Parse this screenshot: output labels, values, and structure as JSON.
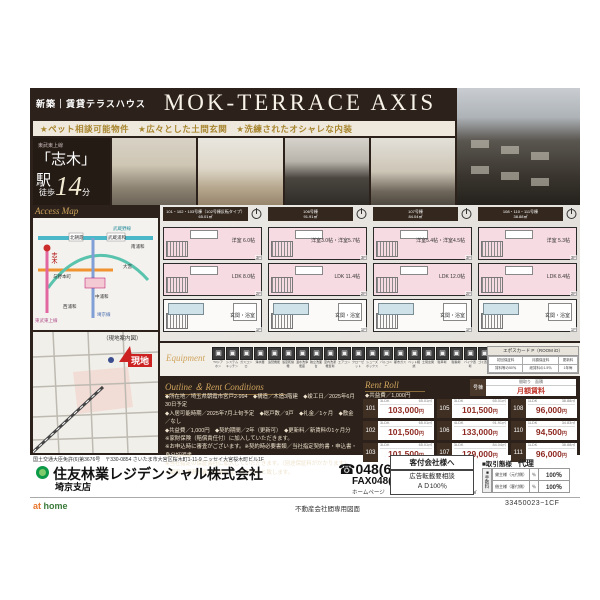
{
  "header": {
    "badge": "新築｜賃貸テラスハウス",
    "title": "MOK-TERRACE AXIS",
    "tagline": "★ペット相談可能物件　★広々とした土間玄関　★洗練されたオシャレな内装"
  },
  "station": {
    "line": "東武東上線",
    "name": "「志木」駅",
    "walk_pre": "徒歩",
    "walk_num": "14",
    "walk_post": "分"
  },
  "access_map": {
    "label": "Access Map",
    "stations": [
      "志木",
      "北朝霞",
      "武蔵浦和",
      "南浦和",
      "大宮",
      "与野本町",
      "中浦和",
      "西浦和"
    ],
    "lines": [
      "武蔵野線",
      "埼京線",
      "東武東上線"
    ],
    "site_caption": "（現地案内図）",
    "site_label": "現地"
  },
  "plans": [
    {
      "title": "101・102・103号棟（102号棟反転タイプ）",
      "area": "65.01㎡",
      "floors": [
        {
          "tag": "3F",
          "label": "洋室 6.0帖"
        },
        {
          "tag": "2F",
          "label": "LDK 8.0帖"
        },
        {
          "tag": "1F",
          "label": "玄関・浴室"
        }
      ]
    },
    {
      "title": "106号棟",
      "area": "91.91㎡",
      "floors": [
        {
          "tag": "3F",
          "label": "洋室3.0帖・洋室5.7帖"
        },
        {
          "tag": "2F",
          "label": "LDK 11.4帖"
        },
        {
          "tag": "1F",
          "label": "玄関・浴室"
        }
      ]
    },
    {
      "title": "107号棟",
      "area": "84.04㎡",
      "floors": [
        {
          "tag": "3F",
          "label": "洋室5.4帖・洋室4.5帖"
        },
        {
          "tag": "2F",
          "label": "LDK 12.0帖"
        },
        {
          "tag": "1F",
          "label": "玄関・浴室"
        }
      ]
    },
    {
      "title": "108・110・111号棟",
      "area": "38.88㎡",
      "floors": [
        {
          "tag": "3F",
          "label": "洋室 5.3帖"
        },
        {
          "tag": "2F",
          "label": "LDK 8.4帖"
        },
        {
          "tag": "1F",
          "label": "玄関・浴室"
        }
      ]
    }
  ],
  "equipment": {
    "label": "Equipment",
    "items": [
      "TVドアホン",
      "システムキッチン",
      "ガスコンロ",
      "浄水器",
      "追焚機能",
      "浴室乾燥機",
      "温水洗浄便座",
      "独立洗面台",
      "室内洗濯機置場",
      "エアコン",
      "クローゼット",
      "シューズボックス",
      "バルコニー",
      "都市ガス",
      "ペット相談",
      "土間玄関",
      "駐車場",
      "駐輪場",
      "バイク置場",
      "ゴミ置場"
    ],
    "card": {
      "title": "エポスカード P（ROOM iD）",
      "headers": [
        "初回保証料",
        "月額保証料",
        "更新料"
      ],
      "values": [
        "賃料等の50％",
        "総賃料の1.5％",
        "1年毎"
      ]
    }
  },
  "outline": {
    "title": "Outline ＆ Rent Conditions",
    "lines": [
      "◆所在地／埼玉県朝霞市宮戸2-994　◆構造／木造3階建　◆竣工日／2025年6月30日予定",
      "◆入居可能時期／2025年7月上旬予定　◆総戸数／9戸　◆礼金／1ヶ月　◆敷金／なし",
      "◆共益費／1,000円　◆契約期間／2年（更新可）　◆更新料／新賃料の1ヶ月分",
      "※家財保険（賠償責任付）に加入していただきます。",
      "※お申込時に審査がございます。※契約時必要書類／当社指定契約書・申込書・身分証明書",
      "※当社指定の保証会社に加入していただきます。（別途保証料がかかります）",
      "※図面と現況が異なる場合は、現況優先と致します。"
    ]
  },
  "rent_roll": {
    "title": "Rent Roll",
    "note": "◆共益費／1,000円",
    "legend": {
      "unit": "号棟",
      "top": "間取り　面積",
      "bottom": "月額賃料"
    },
    "units": [
      {
        "no": "101",
        "plan": "3LDK",
        "size": "65.01㎡",
        "rent": "103,000"
      },
      {
        "no": "102",
        "plan": "3LDK",
        "size": "65.01㎡",
        "rent": "101,500"
      },
      {
        "no": "103",
        "plan": "3LDK",
        "size": "65.01㎡",
        "rent": "101,500"
      },
      {
        "no": "105",
        "plan": "3LDK",
        "size": "65.01㎡",
        "rent": "101,500"
      },
      {
        "no": "106",
        "plan": "4LDK",
        "size": "91.91㎡",
        "rent": "133,000"
      },
      {
        "no": "107",
        "plan": "3LDK",
        "size": "84.04㎡",
        "rent": "129,000"
      },
      {
        "no": "108",
        "plan": "1LDK",
        "size": "38.88㎡",
        "rent": "96,000"
      },
      {
        "no": "110",
        "plan": "1LDK",
        "size": "34.83㎡",
        "rent": "94,500"
      },
      {
        "no": "111",
        "plan": "1LDK",
        "size": "38.88㎡",
        "rent": "96,000"
      }
    ]
  },
  "agency": {
    "license": "国土交通大臣免許(6)第3676号　〒330-0854 さいたま市大宮区桜木町1-11-9 ニッセイ大宮桜木町ビル1F",
    "company": "住友林業レジデンシャル株式会社",
    "branch": "埼京支店",
    "tel": "☎048(648)5981",
    "fax": "FAX048(648)5985",
    "hp": "ホームページ　http://www.sumirin-residential.co.jp/"
  },
  "footer": {
    "kyaku_title": "客付会社様へ",
    "kyaku_line1": "広告転載要相談",
    "kyaku_line2": "ＡＤ100％",
    "torihiki_label": "■取引態様",
    "torihiki_value": "代理",
    "fees_label": "■手数料",
    "fees": [
      {
        "name": "貸主様（元付側）",
        "mid": "％",
        "val": "100％"
      },
      {
        "name": "借主様（客付側）",
        "mid": "％",
        "val": "100％"
      }
    ],
    "athome_a": "at",
    "athome_b": " home",
    "sheet_note": "不動産会社間専用図面",
    "code": "33450023−1CF"
  }
}
